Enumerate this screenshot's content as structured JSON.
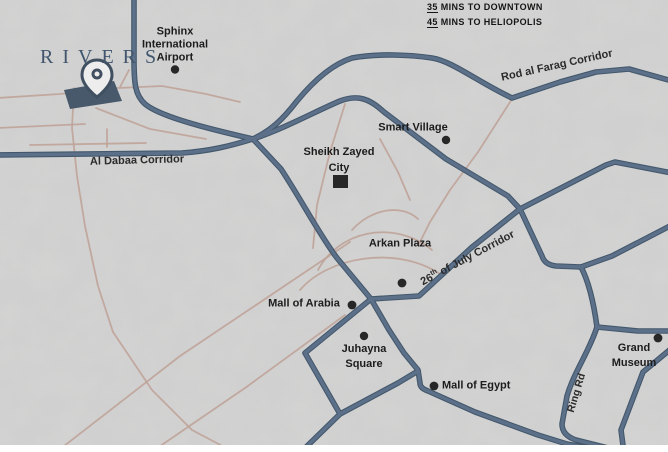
{
  "travel_times": [
    {
      "mins": "35",
      "label": " MINS TO DOWNTOWN"
    },
    {
      "mins": "45",
      "label": " MINS TO HELIOPOLIS"
    }
  ],
  "brand": {
    "name": "RIVERS"
  },
  "roads": {
    "al_dabaa": "Al Dabaa Corridor",
    "rod_al_farag": "Rod al Farag Corridor",
    "july26_num": "26",
    "july26_sup": "th",
    "july26_rest": " of July Corridor",
    "ring_rd": "Ring Rd"
  },
  "places": {
    "airport": {
      "line1": "Sphinx",
      "line2": "International",
      "line3": "Airport"
    },
    "smart_village": "Smart Village",
    "sheikh_zayed": {
      "line1": "Sheikh Zayed",
      "line2": "City"
    },
    "arkan_plaza": "Arkan Plaza",
    "mall_of_arabia": "Mall of Arabia",
    "juhayna": {
      "line1": "Juhayna",
      "line2": "Square"
    },
    "mall_of_egypt": "Mall of Egypt",
    "grand_museum": {
      "line1": "Grand",
      "line2": "Museum"
    }
  },
  "colors": {
    "background": "#e2e2e0",
    "main_road": "#3f5a75",
    "minor_road": "#c6a294",
    "brand": "#41566d",
    "marker": "#111111",
    "pin_outline": "#2c3f52",
    "plot_fill": "#344a5e"
  }
}
